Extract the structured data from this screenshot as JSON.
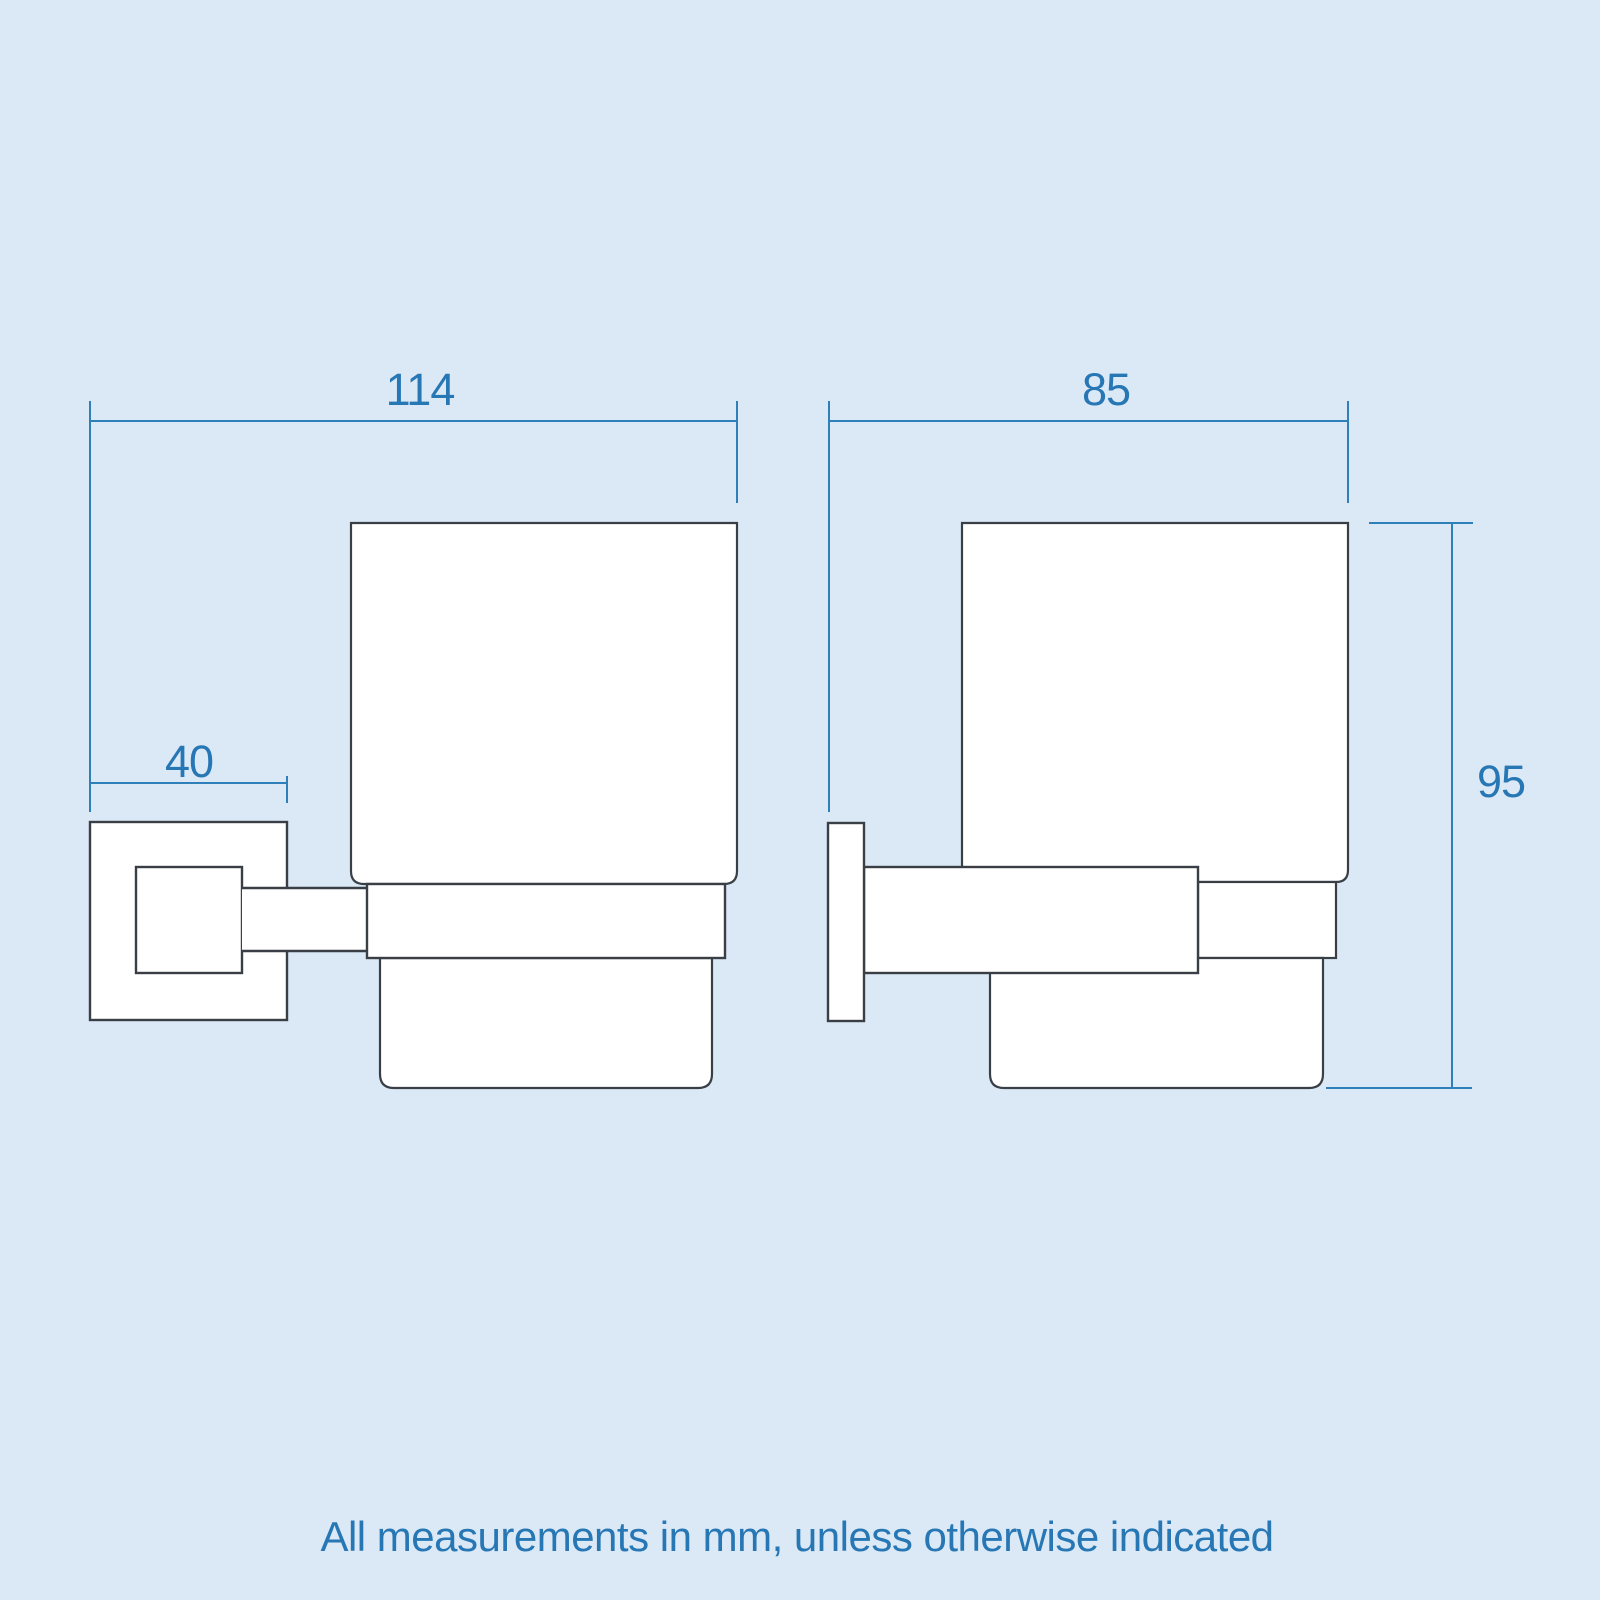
{
  "diagram": {
    "footer_note": "All measurements in mm, unless otherwise indicated",
    "views": {
      "front": {
        "overall_width_mm": "114",
        "wall_plate_width_mm": "40"
      },
      "side": {
        "overall_depth_mm": "85",
        "overall_height_mm": "95"
      }
    },
    "colors": {
      "background": "#dbe9f6",
      "outline": "#3a3f46",
      "shape_fill": "#ffffff",
      "dimension_line": "#2f7fb9",
      "dimension_text": "#2777b5"
    }
  }
}
